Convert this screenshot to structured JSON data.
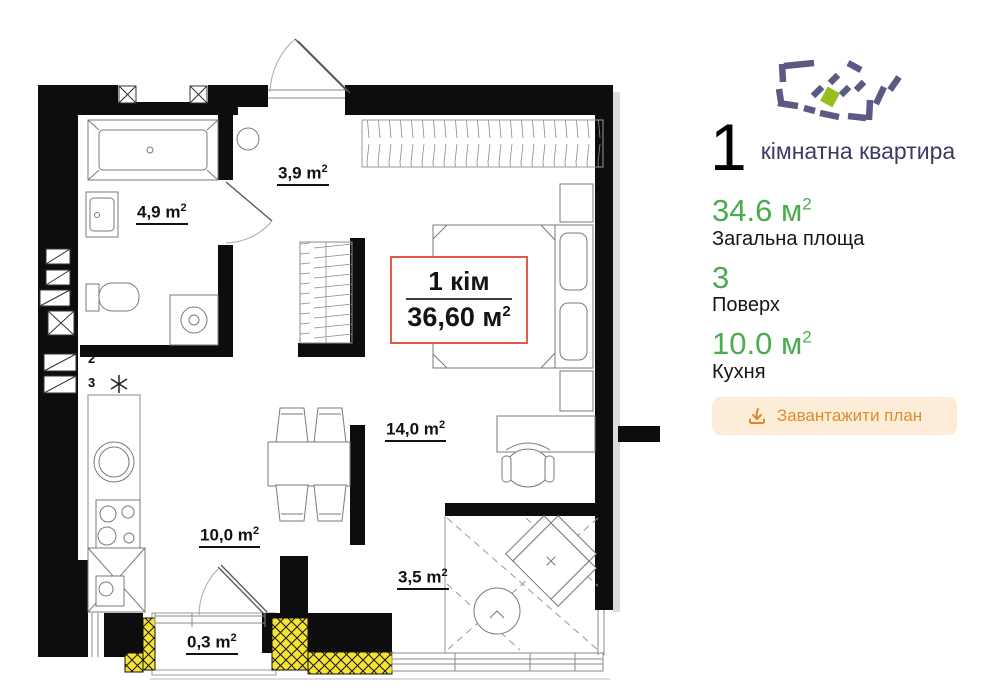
{
  "plan": {
    "summary": {
      "line1": "1 кім",
      "area_value": "36,60 м",
      "area_sup": "2"
    },
    "rooms": [
      {
        "id": "hallway",
        "text": "3,9 m",
        "sup": "2"
      },
      {
        "id": "bathroom",
        "text": "4,9 m",
        "sup": "2"
      },
      {
        "id": "living",
        "text": "14,0 m",
        "sup": "2"
      },
      {
        "id": "kitchen",
        "text": "10,0 m",
        "sup": "2"
      },
      {
        "id": "loggia",
        "text": "3,5 m",
        "sup": "2"
      },
      {
        "id": "balcony",
        "text": "0,3 m",
        "sup": "2"
      }
    ],
    "markers": {
      "riser2": "2",
      "riser3": "3",
      "fridge_icon": "snowflake-icon"
    }
  },
  "panel": {
    "logo_icon": "dashed-buildings-logo",
    "rooms_count": "1",
    "apartment_type": "кімнатна квартира",
    "stats": [
      {
        "value": "34.6",
        "unit": " м",
        "sup": "2",
        "label": "Загальна площа"
      },
      {
        "value": "3",
        "unit": "",
        "sup": "",
        "label": "Поверх"
      },
      {
        "value": "10.0",
        "unit": " м",
        "sup": "2",
        "label": "Кухня"
      }
    ],
    "download_button": {
      "label": "Завантажити план",
      "icon": "download-icon"
    }
  },
  "colors": {
    "accent_green": "#4aab4f",
    "logo_purple": "#5a5a84",
    "logo_green": "#97bf1f",
    "button_bg": "#fcecd8",
    "button_text": "#dd8e2e",
    "summary_border": "#e05c49",
    "insulation_yellow": "#f6e431",
    "wall_black": "#0d0d0d"
  }
}
